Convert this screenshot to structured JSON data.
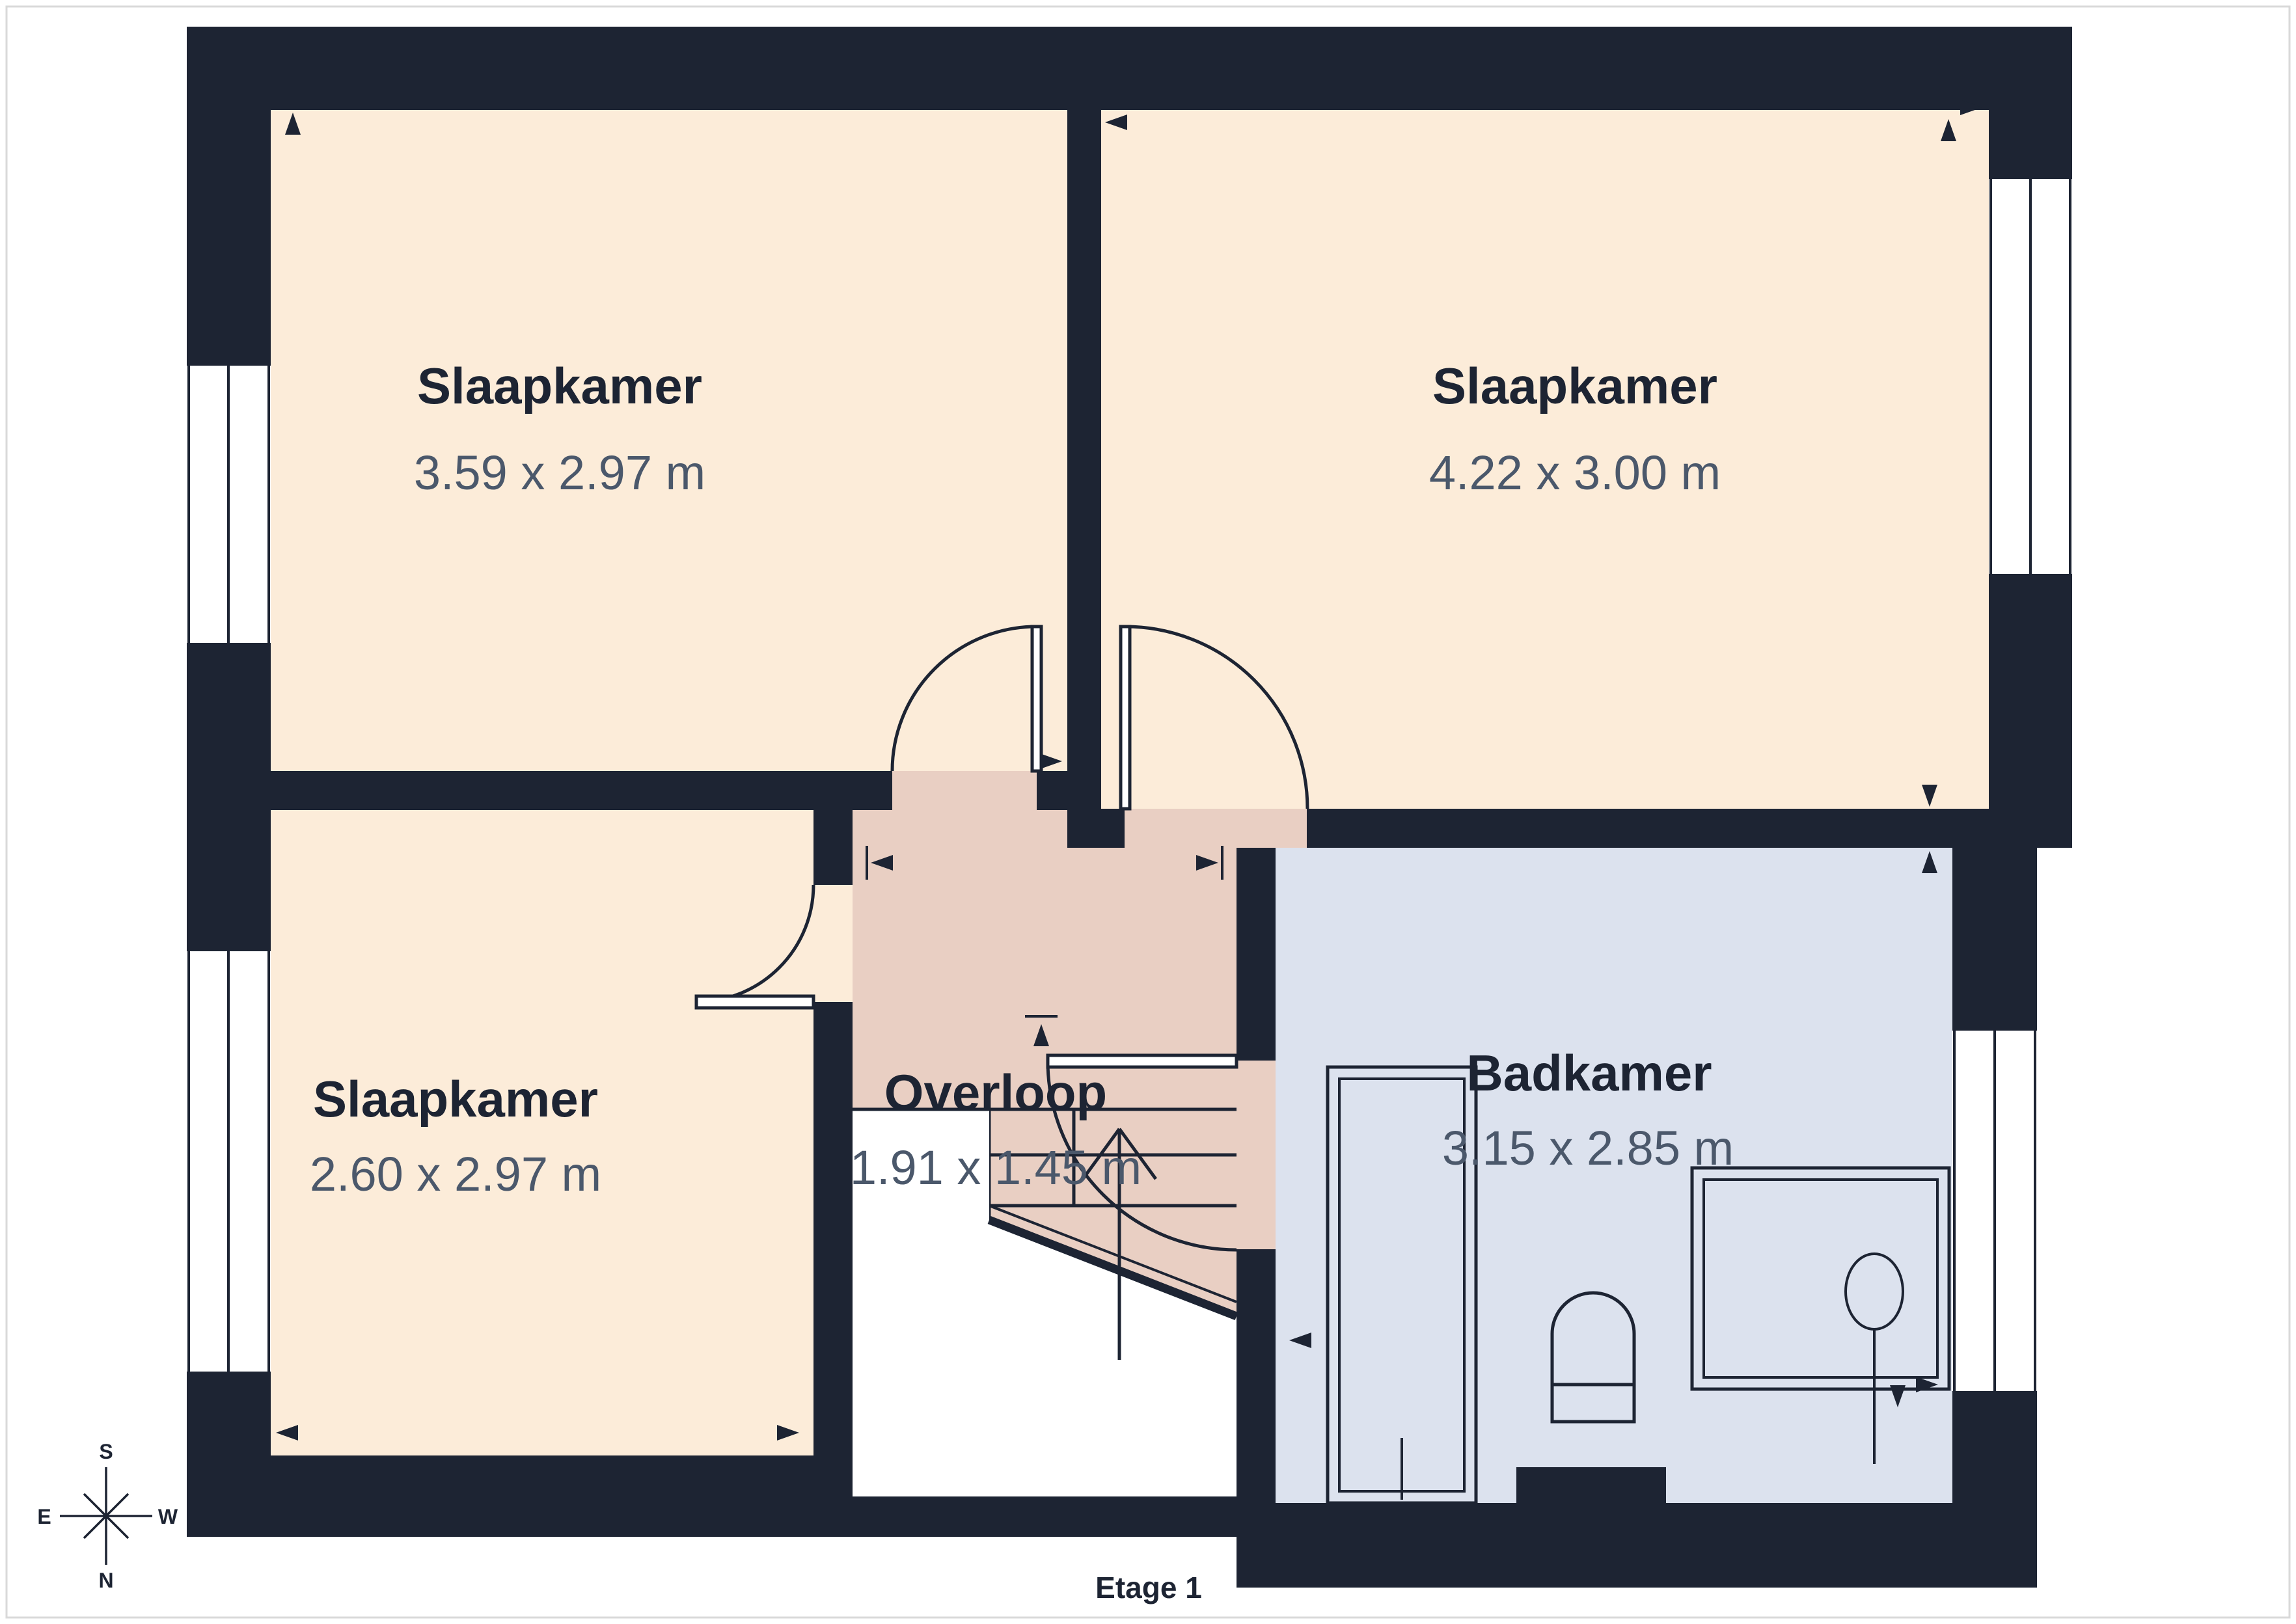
{
  "floor_label": "Etage 1",
  "rooms": {
    "bedroom_top_left": {
      "name": "Slaapkamer",
      "dimensions": "3.59 x 2.97 m"
    },
    "bedroom_top_right": {
      "name": "Slaapkamer",
      "dimensions": "4.22 x 3.00 m"
    },
    "bedroom_bottom_left": {
      "name": "Slaapkamer",
      "dimensions": "2.60 x 2.97 m"
    },
    "landing": {
      "name": "Overloop",
      "dimensions": "1.91 x 1.45 m"
    },
    "bathroom": {
      "name": "Badkamer",
      "dimensions": "3.15 x 2.85 m"
    }
  },
  "compass": {
    "top": "S",
    "left": "E",
    "right": "W",
    "bottom": "N"
  },
  "colors": {
    "wall": "#1d2433",
    "bedroom_fill": "#fcecd9",
    "landing_fill": "#e9cfc3",
    "bathroom_fill": "#dce2ee",
    "dimension_text": "#4b586b",
    "page_border": "#d9d9d9",
    "background": "#ffffff"
  }
}
